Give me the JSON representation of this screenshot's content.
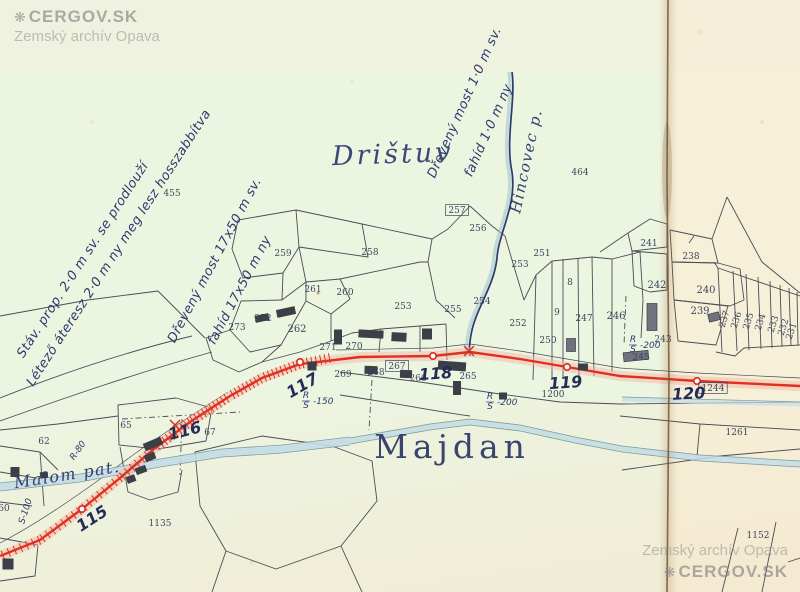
{
  "watermark_top": {
    "brand": "CERGOV.SK",
    "archive": "Zemský archív Opava",
    "icon": "❋"
  },
  "watermark_bottom": {
    "brand": "CERGOV.SK",
    "archive": "Zemský archív Opava",
    "icon": "❋"
  },
  "map": {
    "place_names": [
      {
        "text": "Drištuv",
        "x": 393,
        "y": 163,
        "size": 27,
        "rot": -2,
        "style": "italic"
      },
      {
        "text": "Majdan",
        "x": 452,
        "y": 458,
        "size": 33,
        "rot": 0,
        "style": "upright"
      }
    ],
    "stream_names": [
      {
        "text": "Hincovec p.",
        "x": 531,
        "y": 162,
        "rot": -78,
        "size": 15
      },
      {
        "text": "Malom pat.",
        "x": 68,
        "y": 480,
        "rot": -9,
        "size": 16
      }
    ],
    "annotations": [
      {
        "text": "Stáv. prop. 2·0 m sv. se prodlouží",
        "x": 86,
        "y": 262,
        "rot": -57
      },
      {
        "text": "Létező áteresz 2·0 m ny meg lesz hosszabbítva",
        "x": 122,
        "y": 250,
        "rot": -57
      },
      {
        "text": "Dřevený most 17x50 m sv.",
        "x": 218,
        "y": 262,
        "rot": -62
      },
      {
        "text": "fahíd 17x50 m ny",
        "x": 243,
        "y": 292,
        "rot": -62
      },
      {
        "text": "Dřevený most 1·0 m sv.",
        "x": 468,
        "y": 104,
        "rot": -66
      },
      {
        "text": "fahíd 1·0 m ny",
        "x": 492,
        "y": 132,
        "rot": -66
      }
    ],
    "station_numbers": [
      {
        "text": "115",
        "x": 95,
        "y": 523,
        "rot": -33
      },
      {
        "text": "116",
        "x": 186,
        "y": 436,
        "rot": -14
      },
      {
        "text": "117",
        "x": 305,
        "y": 390,
        "rot": -30
      },
      {
        "text": "118",
        "x": 436,
        "y": 379,
        "rot": -4
      },
      {
        "text": "119",
        "x": 566,
        "y": 388,
        "rot": -4
      },
      {
        "text": "120",
        "x": 689,
        "y": 399,
        "rot": -3
      }
    ],
    "fractions": [
      {
        "top": "R",
        "bottom": "S",
        "value": "150",
        "x": 314,
        "y": 400,
        "rot": 0
      },
      {
        "top": "R",
        "bottom": "S",
        "value": "200",
        "x": 498,
        "y": 401,
        "rot": 0
      },
      {
        "top": "R",
        "bottom": "S",
        "value": "200",
        "x": 641,
        "y": 344,
        "rot": 0
      },
      {
        "top": "R",
        "bottom": "",
        "value": "80",
        "x": 80,
        "y": 452,
        "rot": -55
      },
      {
        "top": "S",
        "bottom": "",
        "value": "100",
        "x": 28,
        "y": 512,
        "rot": -72
      }
    ],
    "parcels": [
      {
        "n": "455",
        "x": 172,
        "y": 196
      },
      {
        "n": "464",
        "x": 580,
        "y": 175
      },
      {
        "n": "259",
        "x": 283,
        "y": 256
      },
      {
        "n": "258",
        "x": 370,
        "y": 255
      },
      {
        "n": "261",
        "x": 313,
        "y": 292
      },
      {
        "n": "260",
        "x": 345,
        "y": 295
      },
      {
        "n": "257",
        "x": 457,
        "y": 213,
        "boxed": true
      },
      {
        "n": "256",
        "x": 478,
        "y": 231
      },
      {
        "n": "251",
        "x": 542,
        "y": 256
      },
      {
        "n": "253",
        "x": 520,
        "y": 267
      },
      {
        "n": "253",
        "x": 403,
        "y": 309
      },
      {
        "n": "254",
        "x": 482,
        "y": 304
      },
      {
        "n": "255",
        "x": 453,
        "y": 312
      },
      {
        "n": "252",
        "x": 518,
        "y": 326
      },
      {
        "n": "250",
        "x": 548,
        "y": 343
      },
      {
        "n": "8",
        "x": 570,
        "y": 285
      },
      {
        "n": "9",
        "x": 557,
        "y": 315
      },
      {
        "n": "247",
        "x": 584,
        "y": 321
      },
      {
        "n": "246",
        "x": 616,
        "y": 319,
        "big": true
      },
      {
        "n": "272",
        "x": 263,
        "y": 321
      },
      {
        "n": "273",
        "x": 237,
        "y": 330
      },
      {
        "n": "262",
        "x": 297,
        "y": 332,
        "big": true
      },
      {
        "n": "271",
        "x": 328,
        "y": 350
      },
      {
        "n": "270",
        "x": 354,
        "y": 349
      },
      {
        "n": "269",
        "x": 343,
        "y": 377
      },
      {
        "n": "268",
        "x": 376,
        "y": 375
      },
      {
        "n": "267",
        "x": 397,
        "y": 369,
        "boxed": true
      },
      {
        "n": "266",
        "x": 418,
        "y": 381
      },
      {
        "n": "265",
        "x": 468,
        "y": 379
      },
      {
        "n": "1200",
        "x": 553,
        "y": 397
      },
      {
        "n": "241",
        "x": 649,
        "y": 246
      },
      {
        "n": "238",
        "x": 691,
        "y": 259
      },
      {
        "n": "242",
        "x": 657,
        "y": 288,
        "big": true
      },
      {
        "n": "240",
        "x": 706,
        "y": 293,
        "big": true
      },
      {
        "n": "239",
        "x": 700,
        "y": 314,
        "big": true
      },
      {
        "n": "243",
        "x": 663,
        "y": 342
      },
      {
        "n": "245",
        "x": 641,
        "y": 360
      },
      {
        "n": "237",
        "x": 727,
        "y": 320,
        "rot": -72
      },
      {
        "n": "236",
        "x": 739,
        "y": 321,
        "rot": -72
      },
      {
        "n": "235",
        "x": 751,
        "y": 322,
        "rot": -72
      },
      {
        "n": "234",
        "x": 763,
        "y": 323,
        "rot": -72
      },
      {
        "n": "233",
        "x": 776,
        "y": 325,
        "rot": -72
      },
      {
        "n": "232",
        "x": 786,
        "y": 328,
        "rot": -72
      },
      {
        "n": "231",
        "x": 794,
        "y": 332,
        "rot": -72
      },
      {
        "n": "1261",
        "x": 737,
        "y": 435
      },
      {
        "n": "1152",
        "x": 758,
        "y": 538
      },
      {
        "n": "1244",
        "x": 713,
        "y": 391,
        "boxed": true
      },
      {
        "n": "62",
        "x": 44,
        "y": 444
      },
      {
        "n": "65",
        "x": 126,
        "y": 428
      },
      {
        "n": "67",
        "x": 210,
        "y": 435
      },
      {
        "n": "60",
        "x": 4,
        "y": 511
      },
      {
        "n": "1135",
        "x": 160,
        "y": 526
      }
    ]
  }
}
